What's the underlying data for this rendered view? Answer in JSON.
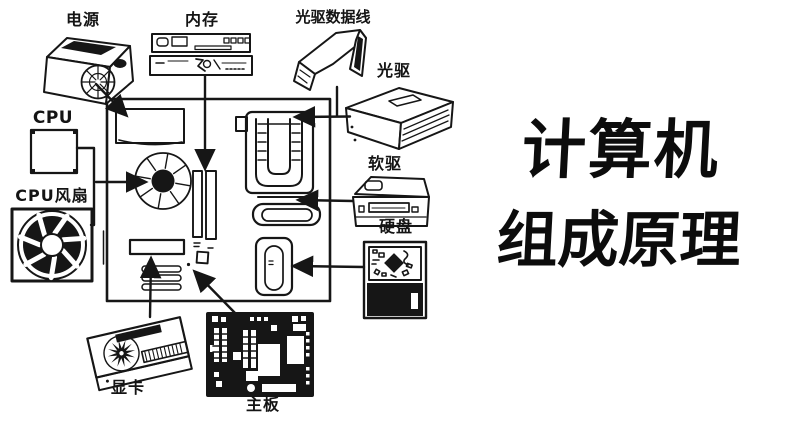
{
  "title": {
    "line1": "计算机",
    "line2": "组成原理"
  },
  "labels": {
    "power": "电源",
    "memory": "内存",
    "optical_cable": "光驱数据线",
    "optical_drive": "光驱",
    "cpu": "CPU",
    "cpu_fan": "CPU风扇",
    "floppy_drive": "软驱",
    "hard_disk": "硬盘",
    "graphics_card": "显卡",
    "motherboard": "主板"
  },
  "colors": {
    "ink": "#161616",
    "background": "#ffffff"
  }
}
